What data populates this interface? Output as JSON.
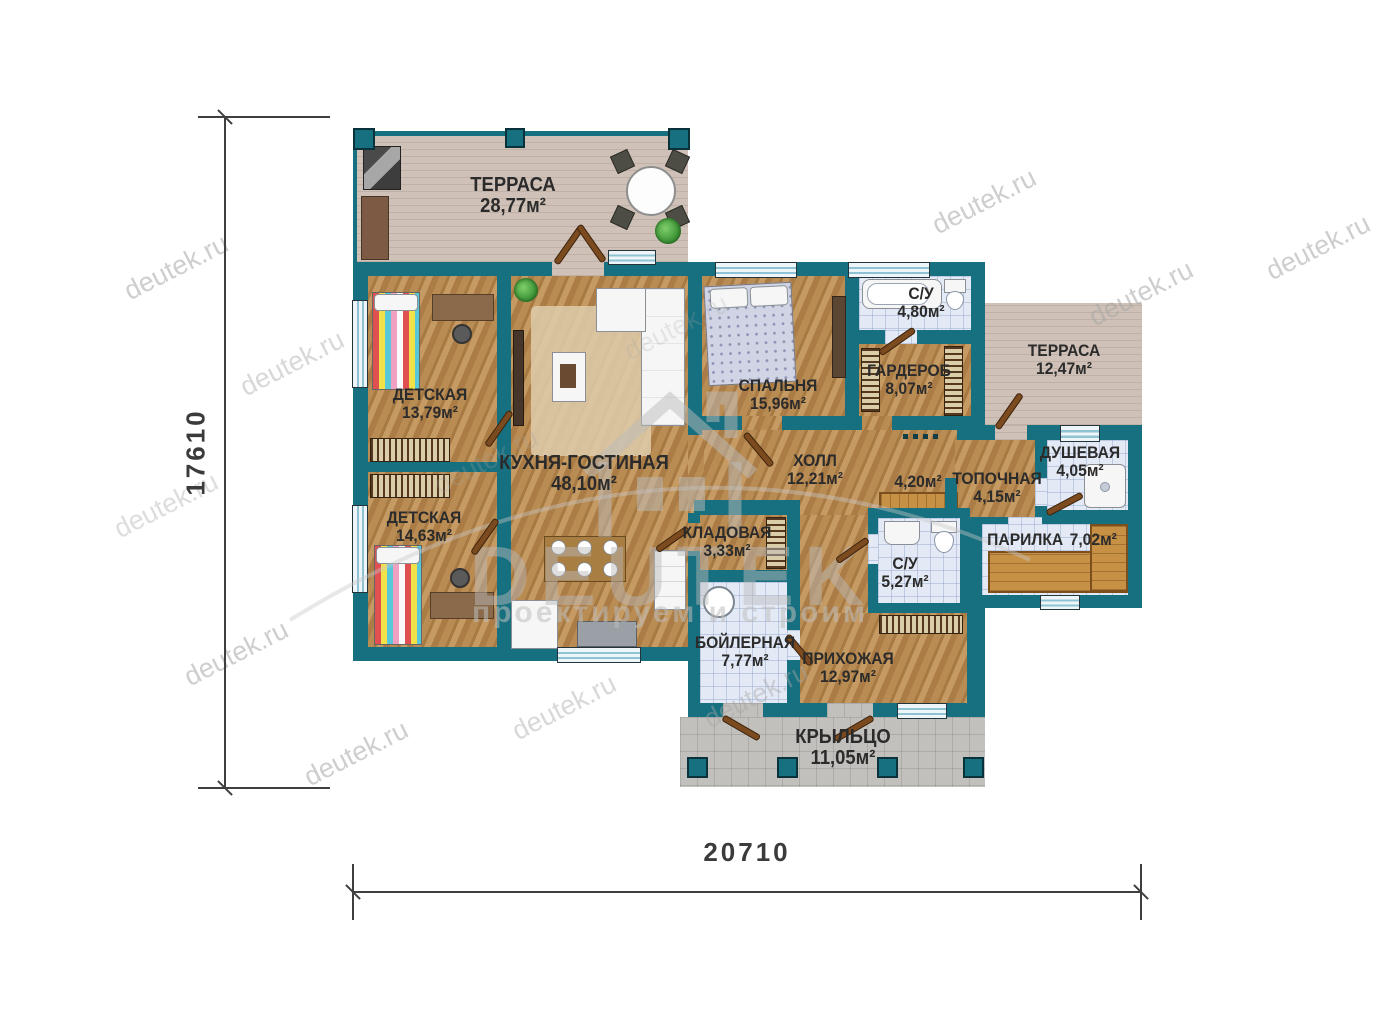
{
  "plan_title": "Одноэтажный жилой дом — план",
  "dimensions": {
    "height_label": "17610",
    "width_label": "20710"
  },
  "watermark": {
    "site": "deutek.ru",
    "logo_text": "DEUTEK",
    "logo_tagline": "проектируем и строим"
  },
  "colors": {
    "wall": "#17707f",
    "wood_floor": "#b5854e",
    "tile_floor": "#e4eaf5",
    "terrace_floor": "#cfc1b7",
    "porch_floor": "#c2c0bc",
    "door_leaf": "#7c4a1f",
    "window": "#8fc2d2",
    "label_text": "#2b2b2b"
  },
  "rooms": {
    "terrace_top": {
      "label": "ТЕРРАСА",
      "area": "28,77м²"
    },
    "terrace_right": {
      "label": "ТЕРРАСА",
      "area": "12,47м²"
    },
    "detskaya1": {
      "label": "ДЕТСКАЯ",
      "area": "13,79м²"
    },
    "detskaya2": {
      "label": "ДЕТСКАЯ",
      "area": "14,63м²"
    },
    "kitchen": {
      "label": "КУХНЯ-ГОСТИНАЯ",
      "area": "48,10м²"
    },
    "bedroom": {
      "label": "СПАЛЬНЯ",
      "area": "15,96м²"
    },
    "su1": {
      "label": "С/У",
      "area": "4,80м²"
    },
    "garderob": {
      "label": "ГАРДЕРОБ",
      "area": "8,07м²"
    },
    "hall": {
      "label": "ХОЛЛ",
      "area": "12,21м²"
    },
    "room420": {
      "label": "",
      "area": "4,20м²"
    },
    "topochnaya": {
      "label": "ТОПОЧНАЯ",
      "area": "4,15м²"
    },
    "dushevaya": {
      "label": "ДУШЕВАЯ",
      "area": "4,05м²"
    },
    "parilka": {
      "label": "ПАРИЛКА",
      "area": "7,02м²"
    },
    "kladovaya": {
      "label": "КЛАДОВАЯ",
      "area": "3,33м²"
    },
    "su2": {
      "label": "С/У",
      "area": "5,27м²"
    },
    "boilernaya": {
      "label": "БОЙЛЕРНАЯ",
      "area": "7,77м²"
    },
    "prihozhaya": {
      "label": "ПРИХОЖАЯ",
      "area": "12,97м²"
    },
    "kryltso": {
      "label": "КРЫЛЬЦО",
      "area": "11,05м²"
    }
  }
}
